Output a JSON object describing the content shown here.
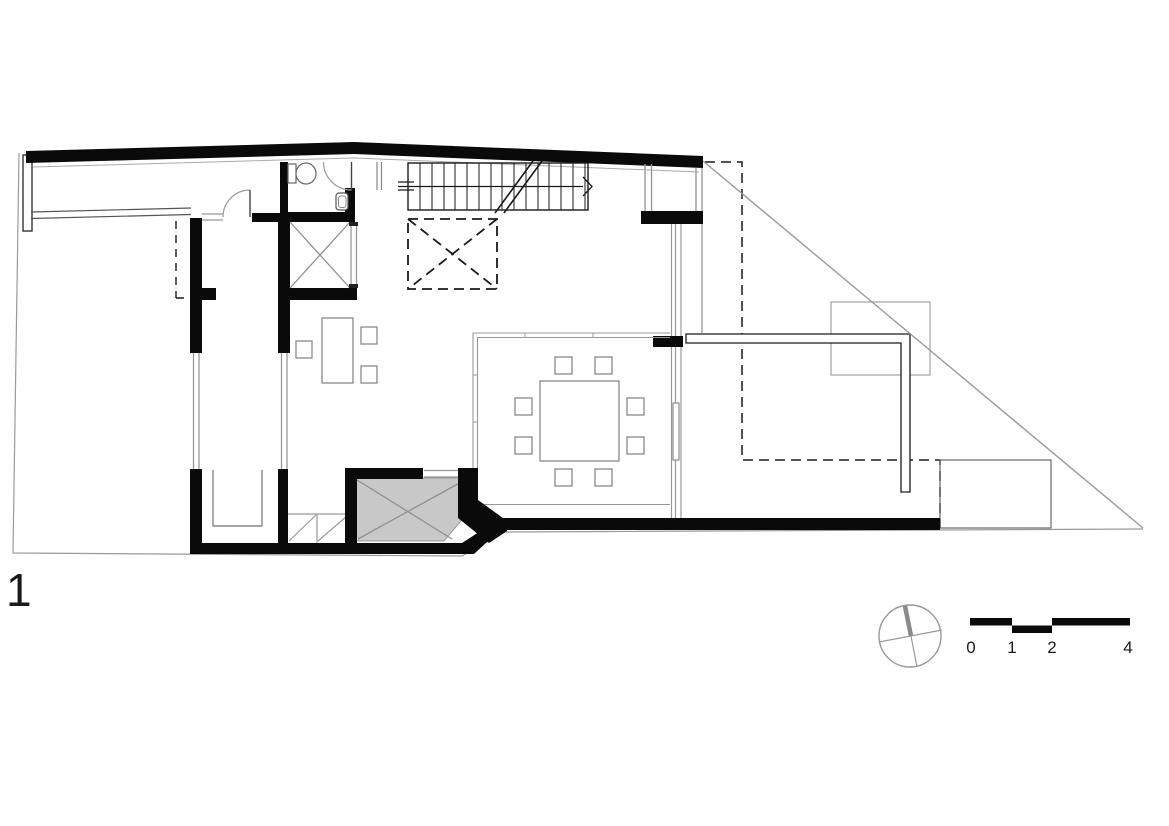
{
  "canvas": {
    "width": 1169,
    "height": 826,
    "background": "#ffffff"
  },
  "plan": {
    "sheet_label": "1",
    "scale_bar": {
      "labels": [
        "0",
        "1",
        "2",
        "4"
      ]
    },
    "icons": {
      "compass": "north-arrow-icon",
      "stair_direction": "arrow-right-icon"
    },
    "colors": {
      "wall": "#0a0a0a",
      "thin_line": "#1a1a1a",
      "glass_line": "#999999",
      "boundary_line": "#9a9a9a",
      "furniture_line": "#8a8a8a",
      "shaded_fill": "#c8c8c8",
      "text": "#1a1a1a"
    }
  }
}
